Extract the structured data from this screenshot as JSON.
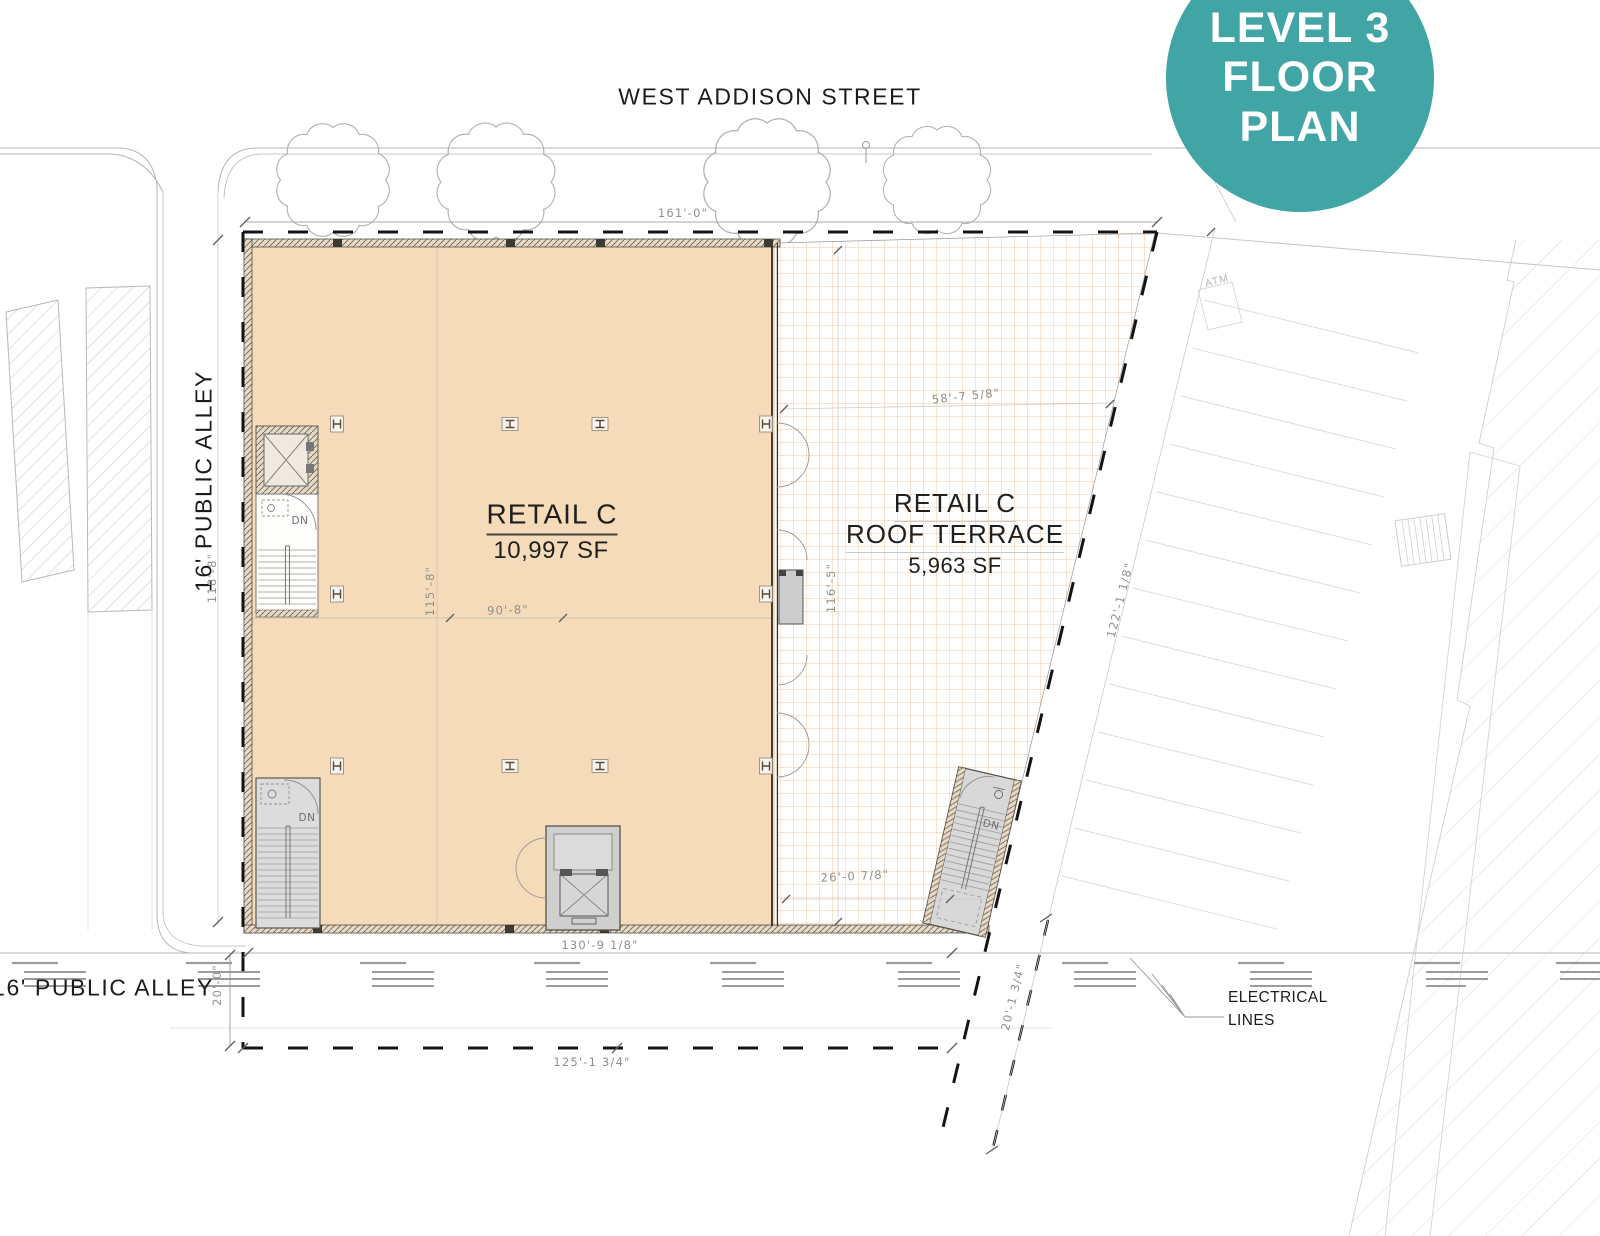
{
  "badge": {
    "line1": "LEVEL 3",
    "line2": "FLOOR PLAN"
  },
  "streets": {
    "top": "WEST ADDISON STREET",
    "left": "16' PUBLIC ALLEY",
    "bottom_alley": "16' PUBLIC ALLEY"
  },
  "retail": {
    "name": "RETAIL C",
    "area": "10,997 SF"
  },
  "terrace": {
    "name": "RETAIL C",
    "subname": "ROOF TERRACE",
    "area": "5,963 SF"
  },
  "dims": {
    "street_frontage": "161'-0\"",
    "west_side": "118'-8\"",
    "retail_depth": "115'-8\"",
    "retail_width": "90'-8\"",
    "terrace_top": "58'-7 5/8\"",
    "terrace_east": "116'-5\"",
    "east_boundary": "122'-1 1/8\"",
    "terrace_bottom": "26'-0 7/8\"",
    "south_building": "130'-9 1/8\"",
    "alley_width": "20'-0\"",
    "south_property": "125'-1 3/4\"",
    "southeast_width": "20'-1 3/4\""
  },
  "labels": {
    "electrical_1": "ELECTRICAL",
    "electrical_2": "LINES",
    "atm": "ATM",
    "dn": "DN"
  },
  "colors": {
    "teal": "#41a5a6",
    "retail_fill": "#f6dbba",
    "terrace_grid": "#f0c9a3"
  }
}
